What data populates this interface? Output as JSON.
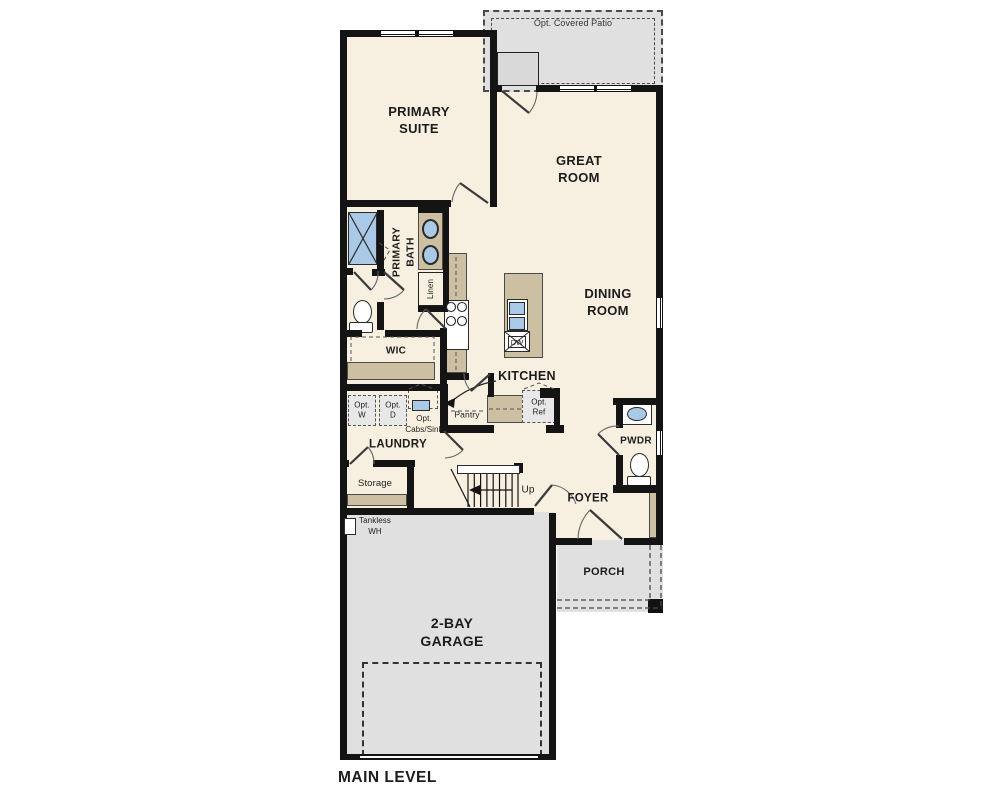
{
  "labels": {
    "patio": "Opt. Covered Patio",
    "primary_suite": "PRIMARY\nSUITE",
    "great_room": "GREAT\nROOM",
    "dining_room": "DINING\nROOM",
    "primary_bath": "PRIMARY\nBATH",
    "linen": "Linen",
    "wic": "WIC",
    "kitchen": "KITCHEN",
    "pantry": "Pantry",
    "dw": "DW",
    "opt_ref": "Opt.\nRef",
    "opt_washer": "Opt.\nW",
    "opt_dryer": "Opt.\nD",
    "opt_cabs_sink": "Opt.\nCabs/Sink",
    "laundry": "LAUNDRY",
    "storage": "Storage",
    "tankless_wh": "Tankless\nWH",
    "up": "Up",
    "foyer": "FOYER",
    "pwdr": "PWDR",
    "porch": "PORCH",
    "garage": "2-BAY\nGARAGE",
    "title": "MAIN LEVEL"
  },
  "colors": {
    "wall": "#141414",
    "floor": "#f7f0e1",
    "outdoor": "#e0e0e0",
    "cabinet": "#cdbfa2",
    "fixture_blue": "#a9c9e6",
    "optional_fill": "#e8e8e8"
  }
}
